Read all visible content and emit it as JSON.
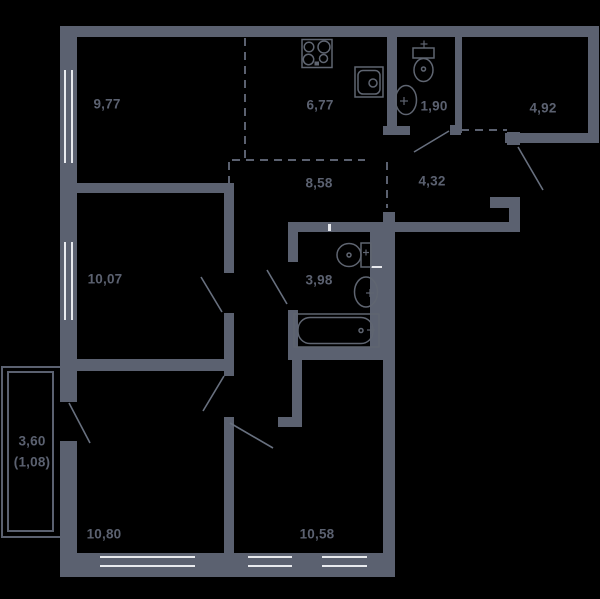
{
  "plan_type": "apartment-floor-plan",
  "colors": {
    "background": "#000000",
    "walls": "#5b6170",
    "door_lines": "#68707f",
    "window_glazing": "#e8eaee",
    "labels": "#5b6170"
  },
  "rooms": [
    {
      "id": "room-top-left",
      "area": "9,77"
    },
    {
      "id": "kitchen",
      "area": "6,77"
    },
    {
      "id": "wc-small",
      "area": "1,90"
    },
    {
      "id": "room-top-right",
      "area": "4,92"
    },
    {
      "id": "corridor",
      "area": "8,58"
    },
    {
      "id": "hallway",
      "area": "4,32"
    },
    {
      "id": "room-mid-left",
      "area": "10,07"
    },
    {
      "id": "bathroom",
      "area": "3,98"
    },
    {
      "id": "room-bottom-left",
      "area": "10,80"
    },
    {
      "id": "room-bottom-right",
      "area": "10,58"
    }
  ],
  "balcony": {
    "area": "3,60",
    "area_reduced": "(1,08)"
  },
  "fixtures": [
    "stove-icon",
    "kitchen-sink-icon",
    "toilet-icon-wc-small",
    "washbasin-icon-wc-small",
    "toilet-icon-bathroom",
    "washbasin-icon-bathroom",
    "bathtub-icon"
  ],
  "doors": [
    "balcony-door",
    "room-10-07-door",
    "bathroom-3-98-door",
    "room-10-80-door",
    "room-10-58-door",
    "wc-1-90-door",
    "entrance-door"
  ],
  "windows": [
    "window-9-77",
    "window-10-07",
    "window-10-80",
    "window-10-58-left",
    "window-10-58-right"
  ]
}
